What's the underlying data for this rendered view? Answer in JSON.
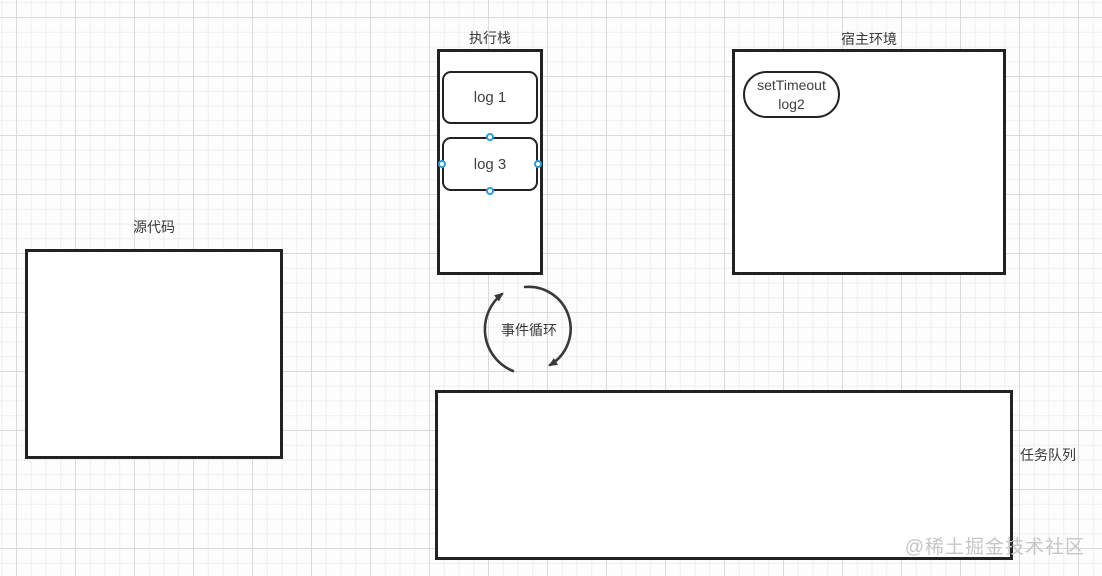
{
  "diagram": {
    "title": "JavaScript event loop diagram",
    "execution_stack": {
      "label": "执行栈",
      "frames": [
        {
          "label": "log 1",
          "selected": false
        },
        {
          "label": "log 3",
          "selected": true
        }
      ]
    },
    "host_environment": {
      "label": "宿主环境",
      "task": {
        "line1": "setTimeout",
        "line2": "log2"
      }
    },
    "source_code": {
      "label": "源代码"
    },
    "event_loop": {
      "label": "事件循环"
    },
    "task_queue": {
      "label": "任务队列"
    }
  },
  "watermark": {
    "text": "@稀土掘金技术社区",
    "color": "#c6c6c6"
  },
  "colors": {
    "background": "#fdfdfd",
    "grid_minor": "#efefef",
    "grid_major": "#dadada",
    "shape_stroke": "#222222",
    "shape_fill": "#ffffff",
    "label_text": "#383838",
    "arrow_stroke": "#3a3a3a",
    "selection_handle_stroke": "#2e9bd8",
    "selection_handle_fill": "#ffffff"
  }
}
